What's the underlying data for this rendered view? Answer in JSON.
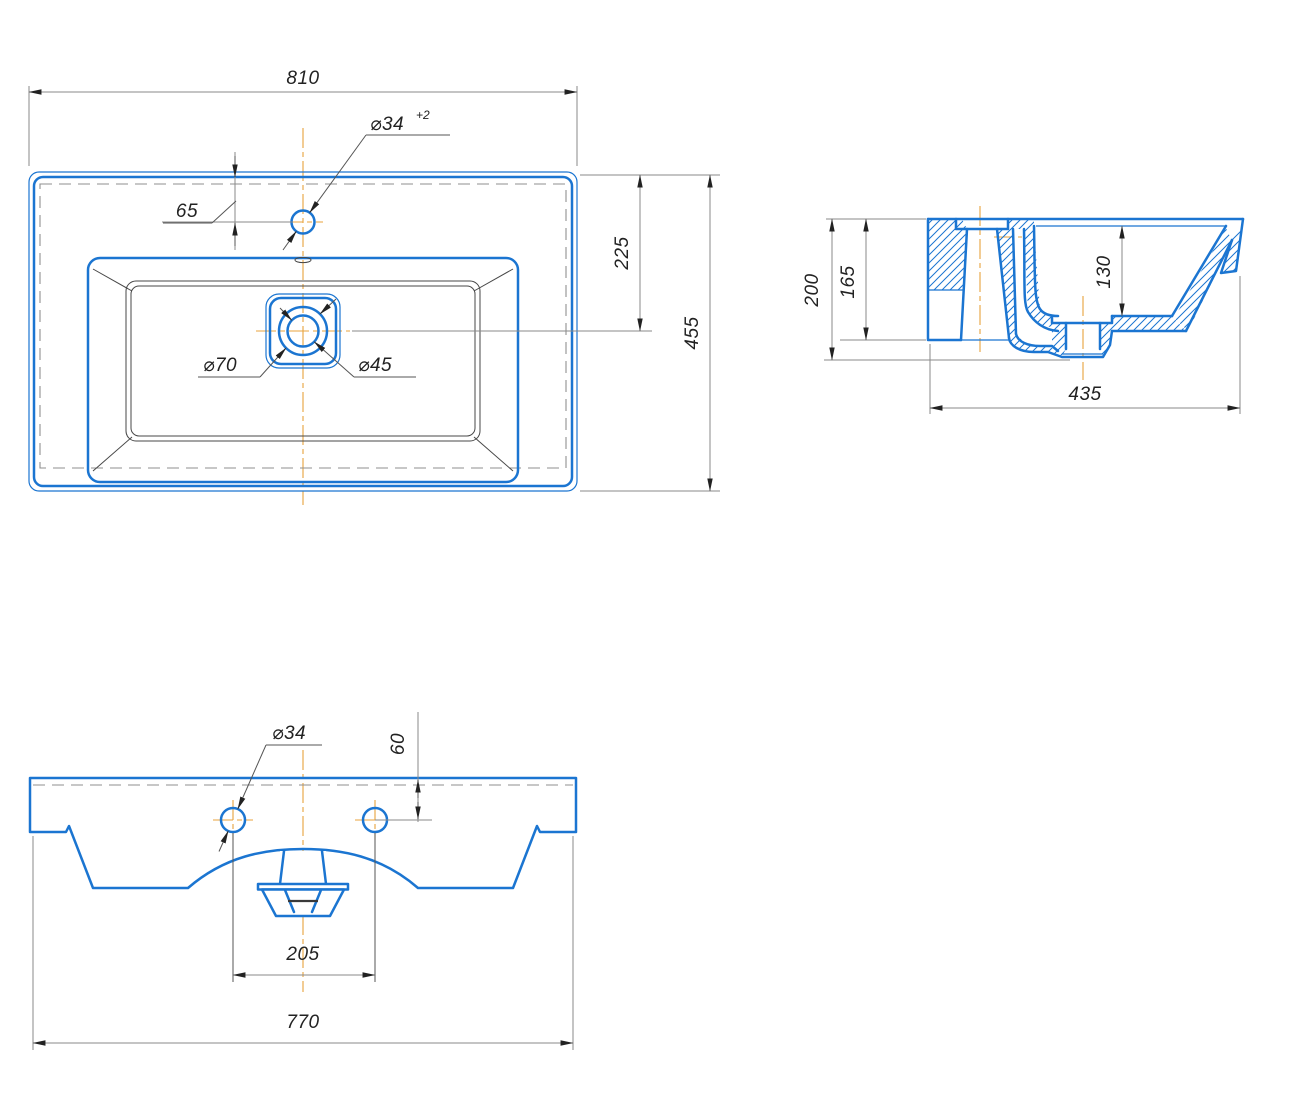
{
  "drawing": {
    "colors": {
      "line_blue": "#1b75d1",
      "centerline_orange": "#e8a33c",
      "dimension_gray": "#8a8a8a",
      "text_dark": "#222222"
    },
    "views": {
      "top": {
        "dims": {
          "overall_width": "810",
          "overall_depth": "455",
          "faucet_hole_dia": "⌀34",
          "faucet_hole_tolerance": "+2",
          "faucet_hole_offset": "65",
          "drain_center_offset": "225",
          "drain_flange_dia": "⌀70",
          "drain_hole_dia": "⌀45"
        }
      },
      "section": {
        "dims": {
          "overall_height": "200",
          "rear_wall_height": "165",
          "bowl_depth": "130",
          "overall_depth": "435"
        }
      },
      "front": {
        "dims": {
          "mount_hole_dia": "⌀34",
          "mount_hole_offset": "60",
          "mount_hole_spacing": "205",
          "overall_width": "770"
        }
      }
    }
  }
}
